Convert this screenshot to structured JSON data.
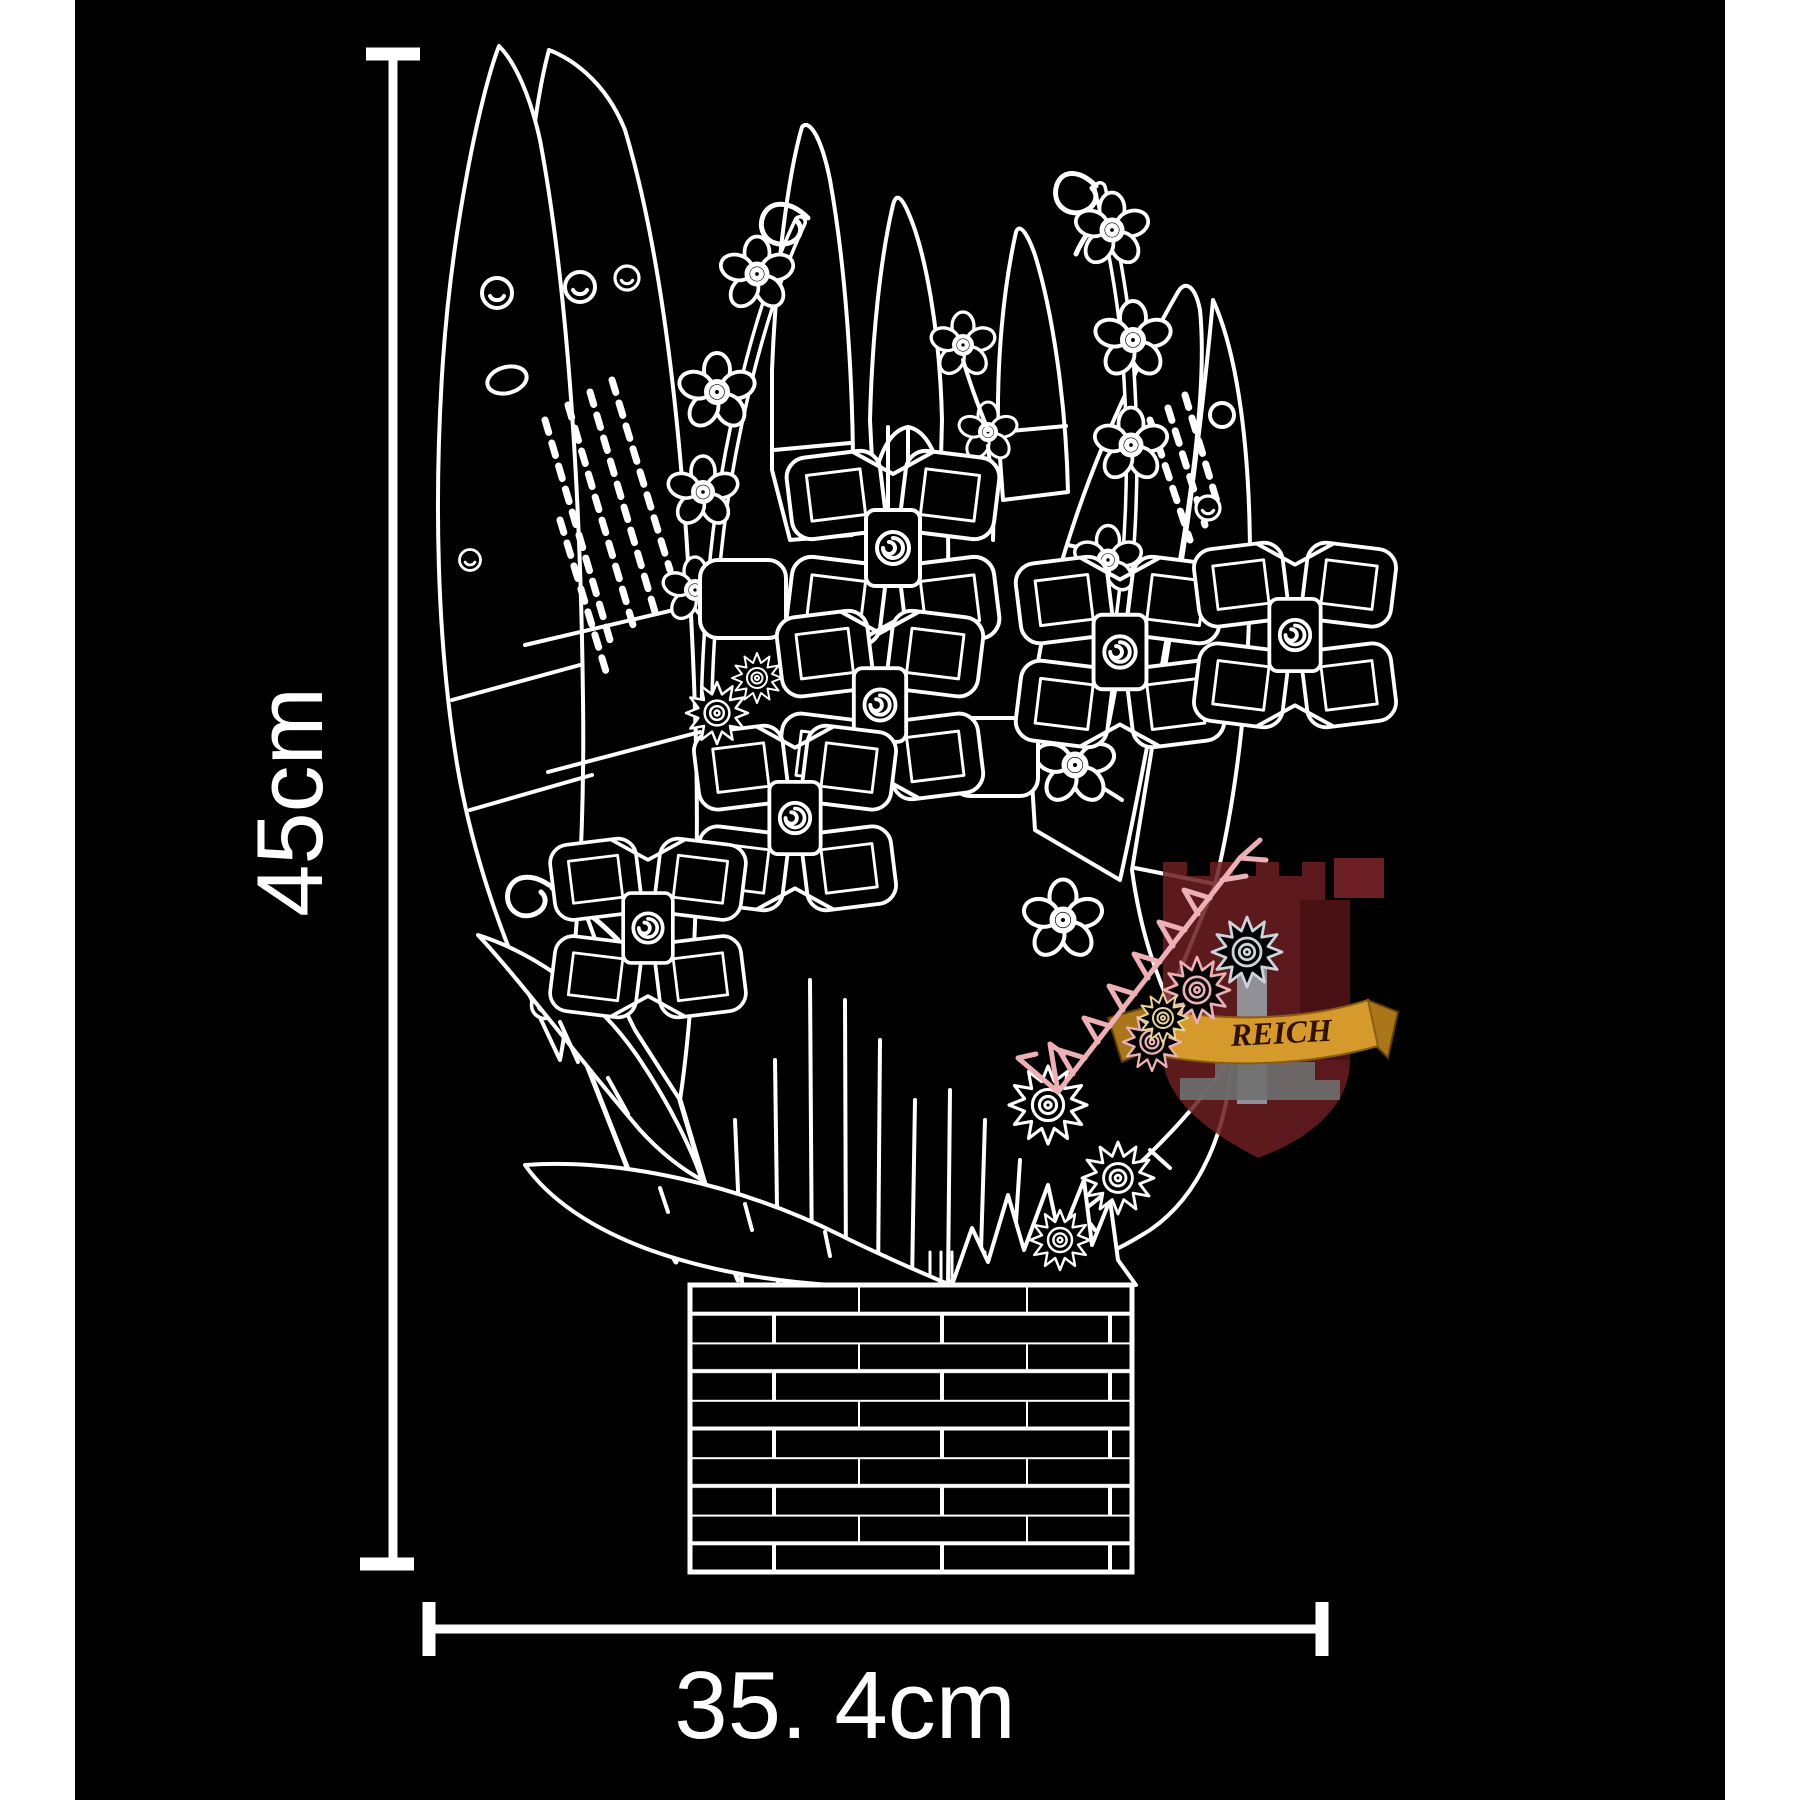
{
  "page": {
    "margin_color": "#ffffff",
    "background": "#000000"
  },
  "dimensions": {
    "vertical_label": "45cm",
    "horizontal_label": "35. 4cm",
    "line_color": "#ffffff"
  },
  "artwork": {
    "line_color": "#ffffff",
    "subject": "brick-built-flower-bouquet-line-art",
    "pot_style": "brick-pattern-planter"
  },
  "watermark": {
    "banner_text": "REICH",
    "shield_color": "#6b1e22",
    "shield_side_color": "#7d2429",
    "banner_color": "#d59a2b",
    "banner_fold_color": "#a9761a",
    "banner_text_color": "#2f1105",
    "block_color": "#9aa0a8",
    "steps_color": "#6f6f6f",
    "tint_color": "#ecb0b6",
    "silver_tint_color": "#ccd3da"
  }
}
